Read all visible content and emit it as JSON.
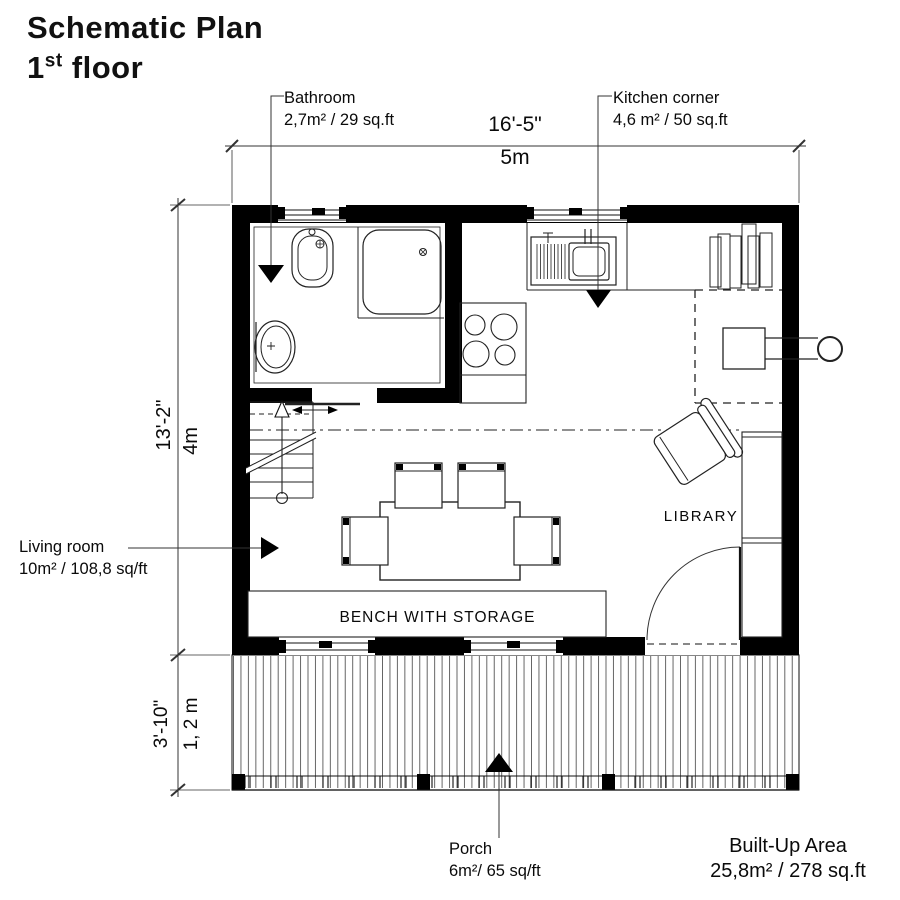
{
  "title": {
    "line1": "Schematic Plan",
    "floor_number": "1",
    "floor_ordinal": "st",
    "floor_word": "floor"
  },
  "rooms": {
    "bathroom": {
      "name": "Bathroom",
      "area": "2,7m² / 29 sq.ft"
    },
    "kitchen": {
      "name": "Kitchen corner",
      "area": "4,6 m² / 50 sq.ft"
    },
    "living_room": {
      "name": "Living room",
      "area": "10m² / 108,8 sq/ft"
    },
    "porch": {
      "name": "Porch",
      "area": "6m²/ 65 sq/ft"
    }
  },
  "annotations": {
    "bench": "BENCH WITH STORAGE",
    "library": "LIBRARY"
  },
  "dimensions": {
    "overall_width": {
      "imperial": "16'-5\"",
      "metric": "5m"
    },
    "overall_depth": {
      "imperial": "13'-2\"",
      "metric": "4m"
    },
    "porch_depth": {
      "imperial": "3'-10\"",
      "metric": "1, 2 m"
    }
  },
  "summary": {
    "label": "Built-Up Area",
    "value": "25,8m² / 278 sq.ft"
  },
  "colors": {
    "ink": "#000000",
    "paper": "#ffffff"
  }
}
